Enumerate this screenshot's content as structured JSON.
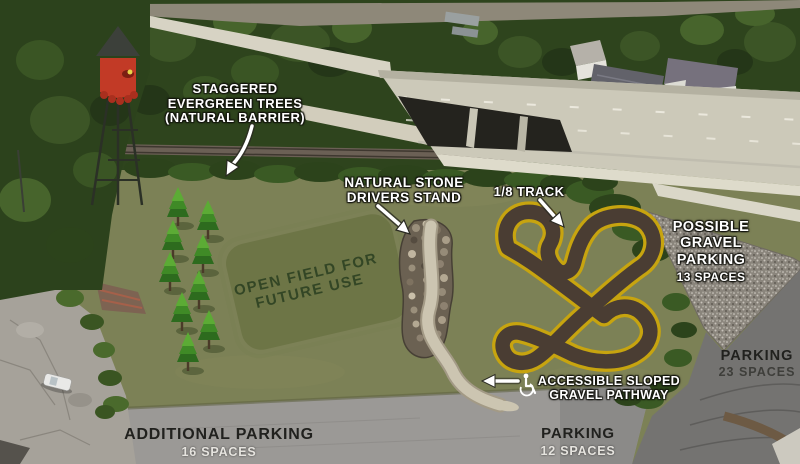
{
  "scene": {
    "kind": "annotated aerial site plan",
    "width": 800,
    "height": 464
  },
  "colors": {
    "field": "#7c8156",
    "open_field_patch": "#6d7446",
    "forest": "#2e441d",
    "track_surface": "#4a3d33",
    "track_border": "#c7a40f",
    "gravel_path": "#ccc5b1",
    "stone_stand": "#6b6152",
    "gravel_parking": "#8a857c",
    "highway_concrete": "#ccc9b9",
    "asphalt_light": "#9b9996",
    "asphalt_dark": "#747371",
    "water_tower_red": "#c23a26"
  },
  "annotations": {
    "evergreen_trees": {
      "lines": [
        "STAGGERED",
        "EVERGREEN TREES",
        "(NATURAL BARRIER)"
      ]
    },
    "drivers_stand": {
      "lines": [
        "NATURAL STONE",
        "DRIVERS STAND"
      ]
    },
    "track": {
      "label": "1/8 TRACK"
    },
    "gravel_parking": {
      "lines": [
        "POSSIBLE",
        "GRAVEL",
        "PARKING"
      ],
      "spaces": "13 SPACES"
    },
    "parking_east": {
      "label": "PARKING",
      "spaces": "23 SPACES"
    },
    "pathway": {
      "lines": [
        "ACCESSIBLE SLOPED",
        "GRAVEL PATHWAY"
      ],
      "icon": "wheelchair-icon"
    },
    "open_field": {
      "lines": [
        "OPEN FIELD FOR",
        "FUTURE USE"
      ]
    },
    "additional_parking": {
      "label": "ADDITIONAL PARKING",
      "spaces": "16 SPACES"
    },
    "parking_south": {
      "label": "PARKING",
      "spaces": "12 SPACES"
    }
  }
}
